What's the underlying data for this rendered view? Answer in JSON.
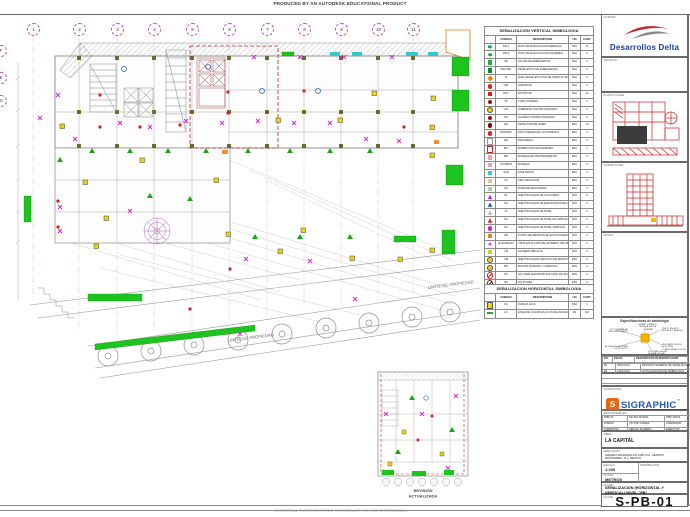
{
  "banner": {
    "text": "PRODUCED BY AN AUTODESK EDUCATIONAL PRODUCT"
  },
  "plan": {
    "grid_columns": [
      {
        "n": "1",
        "s": "left:27px"
      },
      {
        "n": "2",
        "s": "left:73px"
      },
      {
        "n": "3",
        "s": "left:111px"
      },
      {
        "n": "4",
        "s": "left:148px"
      },
      {
        "n": "5",
        "s": "left:186px"
      },
      {
        "n": "6",
        "s": "left:223px"
      },
      {
        "n": "7",
        "s": "left:261px"
      },
      {
        "n": "8",
        "s": "left:298px"
      },
      {
        "n": "9",
        "s": "left:335px"
      },
      {
        "n": "10",
        "s": "left:372px"
      },
      {
        "n": "11",
        "s": "left:407px"
      }
    ],
    "grid_rows": [
      {
        "n": "F",
        "s": "left:-5px;top:45px"
      },
      {
        "n": "E",
        "s": "left:-5px;top:72px"
      },
      {
        "n": "D",
        "s": "left:-5px;top:95px"
      }
    ],
    "limit_label_1": "LIMITE DE PROPIEDAD",
    "limit_label_2": "LIMITE DE PROPIEDAD",
    "inset_label_1": "REVISIÓN",
    "inset_label_2": "ACTUALIZADA"
  },
  "vertical_legend": {
    "title": "SEÑALIZACIÓN VERTICAL SIMBOLOGIA",
    "headers": [
      "CODIGO",
      "DESCRIPCION",
      "UN",
      "CANT"
    ],
    "rows": [
      {
        "icon": "sym ar c-green",
        "code": "RS-2",
        "desc": "RUTA DE EVACUACION DERECHA",
        "un": "PZA",
        "cant": "8"
      },
      {
        "icon": "sym al c-green",
        "code": "RS-3",
        "desc": "RUTA DE EVACUACION IZQUIERDA",
        "un": "PZA",
        "cant": "6"
      },
      {
        "icon": "sym c-green",
        "code": "SE",
        "desc": "SALIDA DE EMERGENCIA",
        "un": "PZA",
        "cant": "4"
      },
      {
        "icon": "sym c-dgreen",
        "code": "PEA/TEL",
        "desc": "SEÑALETICA DE EMERGENCIA",
        "un": "PZA",
        "cant": "2"
      },
      {
        "icon": "sym di c-orange",
        "code": "IS",
        "desc": "QUE HACER EN CASO DE SISMO E INCENDIO",
        "un": "PZA",
        "cant": "2"
      },
      {
        "icon": "sym ci c-red",
        "code": "HID",
        "desc": "HIDRANTE",
        "un": "PZA",
        "cant": "4"
      },
      {
        "icon": "sym c-red",
        "code": "EXT",
        "desc": "EXTINTOR",
        "un": "PZA",
        "cant": "12"
      },
      {
        "icon": "sym ci c-dred",
        "code": "TS",
        "desc": "TOMA SIAMESA",
        "un": "PZA",
        "cant": "1"
      },
      {
        "icon": "sym ci c-yellow",
        "code": "GCI",
        "desc": "GABINETE CONTRA INCENDIO",
        "un": "PZA",
        "cant": "4"
      },
      {
        "icon": "sym ci c-dred",
        "code": "ACI",
        "desc": "ALARMA CONTRA INCENDIO",
        "un": "PZA",
        "cant": "6"
      },
      {
        "icon": "sym ci c-maroon",
        "code": "DH",
        "desc": "DETECTOR DE HUMO",
        "un": "PZA",
        "cant": "10"
      },
      {
        "icon": "sym ci c-red",
        "code": "EPS/SPA",
        "desc": "SOLO PERSONAL AUTORIZADO",
        "un": "PZA",
        "cant": "4"
      },
      {
        "icon": "sym c-white",
        "code": "RE",
        "desc": "REGADERA",
        "un": "PZA",
        "cant": "2"
      },
      {
        "icon": "sym c-redout",
        "code": "BCI",
        "desc": "BOMBA CONTRA INCENDIO",
        "un": "PZA",
        "cant": "1"
      },
      {
        "icon": "sym c-pink",
        "code": "BM",
        "desc": "BODEGA DE MANTENIMIENTO",
        "un": "PZA",
        "cant": "2"
      },
      {
        "icon": "sym c-pink",
        "code": "CTO/BOD",
        "desc": "BODEGA",
        "un": "PZA",
        "cant": "2"
      },
      {
        "icon": "sym c-cyan",
        "code": "SAN",
        "desc": "SANITARIOS",
        "un": "PZA",
        "cant": "4"
      },
      {
        "icon": "sym c-peach",
        "code": "VU",
        "desc": "VER UBICACION",
        "un": "PZA",
        "cant": "2"
      },
      {
        "icon": "sym c-ltgreen",
        "code": "ZS",
        "desc": "ZONA DE SEGURIDAD",
        "un": "PZA",
        "cant": "3"
      },
      {
        "icon": "sym tr c-magenta",
        "code": "NL",
        "desc": "IDENTIFICADOR DE LOCATARIO",
        "un": "PZA",
        "cant": "6"
      },
      {
        "icon": "sym tr c-blue",
        "code": "NA",
        "desc": "IDENTIFICADOR DE ELEVADOR PARA USO DE BOMBEROS",
        "un": "PZA",
        "cant": "2"
      },
      {
        "icon": "sym tr c-gray",
        "code": "NI",
        "desc": "IDENTIFICADOR DE NIVEL",
        "un": "PZA",
        "cant": "4"
      },
      {
        "icon": "sym tr c-red",
        "code": "NC",
        "desc": "IDENTIFICADOR DE NIVEL EN CRISTAL",
        "un": "PZA",
        "cant": "4"
      },
      {
        "icon": "sym ci c-magenta",
        "code": "NV",
        "desc": "IDENTIFICADOR DE NIVEL VERTICAL",
        "un": "PZA",
        "cant": "2"
      },
      {
        "icon": "sym c-orange",
        "code": "PE",
        "desc": "PUNTO DE REUNION EN ESTACIONAMIENTO (LUMINARIA)",
        "un": "PZA",
        "cant": "1"
      },
      {
        "icon": "sym fl c-magenta",
        "code": "ELEV/BAND",
        "desc": "VISTA EN PLANTA DE LETRERO TIPO BANDERA",
        "un": "PZA",
        "cant": "4"
      },
      {
        "icon": "sym c-ygreen",
        "code": "LB",
        "desc": "LETRERO BRAILLE",
        "un": "PZA",
        "cant": "2"
      },
      {
        "icon": "sym ci c-yellow",
        "code": "CM",
        "desc": "IDENTIFICADOR CIRCUITO DE MONITOREO",
        "un": "PZA",
        "cant": "2"
      },
      {
        "icon": "sym ci c-yellow",
        "code": "BS",
        "desc": "BOCINA SONORA Y LUMINOSA",
        "un": "PZA",
        "cant": "4"
      },
      {
        "icon": "sym ri c-red",
        "code": "NU",
        "desc": "NO USAR ELEVADOR EN CASO DE SISMO O INCENDIO",
        "un": "PZA",
        "cant": "2"
      },
      {
        "icon": "sym ri c-dred",
        "code": "NF",
        "desc": "NO FUMAR",
        "un": "PZA",
        "cant": "3"
      }
    ]
  },
  "horizontal_legend": {
    "title": "SEÑALIZACION HORIZONTAL SIMBOLOGIA",
    "headers": [
      "CODIGO",
      "DESCRIPCION",
      "UN",
      "CANT"
    ],
    "rows": [
      {
        "icon": "sym c-yellow",
        "code": "FG",
        "desc": "FRANJA GUIA",
        "un": "PZA",
        "cant": "1"
      },
      {
        "icon": "sym bar c-green",
        "code": "LC",
        "desc": "LINEA DE COLOR EN 10 CM DE ANCHO",
        "un": "ML",
        "cant": "110"
      }
    ]
  },
  "titleblock": {
    "cliente_label": "CLIENTE:",
    "client_name": "Desarrollos Delta",
    "croquis_label": "CROQUIS:",
    "planta_clave_label": "PLANTA CLAVE:",
    "corte_clave_label": "CORTE CLAVE:",
    "notas_label": "NOTAS:",
    "spec_title": "Especificaciones de simbología",
    "spec_callouts": [
      {
        "t": "PICTOGRAMA EN VINIL REFLEJANTE",
        "s": "left:2px;top:11px;text-align:right"
      },
      {
        "t": "SEÑAL SOBRE EL MURO A EJE DE PUERTA",
        "s": "left:34px;top:6px;text-align:center"
      },
      {
        "t": "TEXTO EN ALTO RELIEVE Y BRAILLE",
        "s": "left:60px;top:10px"
      },
      {
        "t": "SUSTRATO RIGIDO ACM 3 MM TORNILLERIA OCULTA",
        "s": "left:60px;top:26px"
      },
      {
        "t": "ALTURA DE MONTAJE 2.10 M S.N.P.T.",
        "s": "left:2px;top:28px;text-align:right"
      },
      {
        "t": "COLORES SEGUN NORMA OFICIAL",
        "s": "left:46px;top:33px"
      }
    ],
    "revisions": {
      "headers": [
        "NO.",
        "FECHA",
        "DESCRIPCION DE MODIFICACION"
      ],
      "rows": [
        [
          "R1",
          "05/NOV/12",
          "REVISION GENERAL DE SEÑALIZACION"
        ],
        [
          "R2",
          "12/NOV/12",
          "ACTUALIZACION DE SIMBOLOGIA"
        ]
      ]
    },
    "consultor_label": "CONSULTOR:",
    "consultor_initial": "S",
    "consultor_name": "SIGRAPHIC",
    "consultor_tm": "™",
    "consultor_tagline": "SEÑALIZACION GRAFICA ARQUITECTONICA · MONTERREY, MEXICO",
    "responsables_label": "RESPONSABLES:",
    "responsables": [
      [
        "DIBUJO",
        "FELIPE RIVERA",
        "DIBUJANTE"
      ],
      [
        "DISEÑO",
        "VICTOR JUAREZ",
        "DISEÑADOR"
      ],
      [
        "SUPERVISO",
        "SERGIO ROMERO",
        "DIRECTOR"
      ]
    ],
    "obra_label": "OBRA:",
    "obra": "LA CAPITAL",
    "direccion_label": "DIRECCION:",
    "direccion": "AVENIDA WASHINGTON 3405 COL. CENTRO, MONTERREY, N.L. MEXICO",
    "escala_label": "ESCALA:",
    "escala": "1:200",
    "cotas_label": "COTAS:",
    "cotas": "METROS",
    "aprobacion_label": "APROBACION:",
    "plano_label": "PLANO:",
    "plano": "SEÑALIZACIÓN (HORIZONTAL Y VERTICAL) NIVEL \"PB\"",
    "clave_label": "CLAVE:",
    "clave": "S-PB-01"
  }
}
